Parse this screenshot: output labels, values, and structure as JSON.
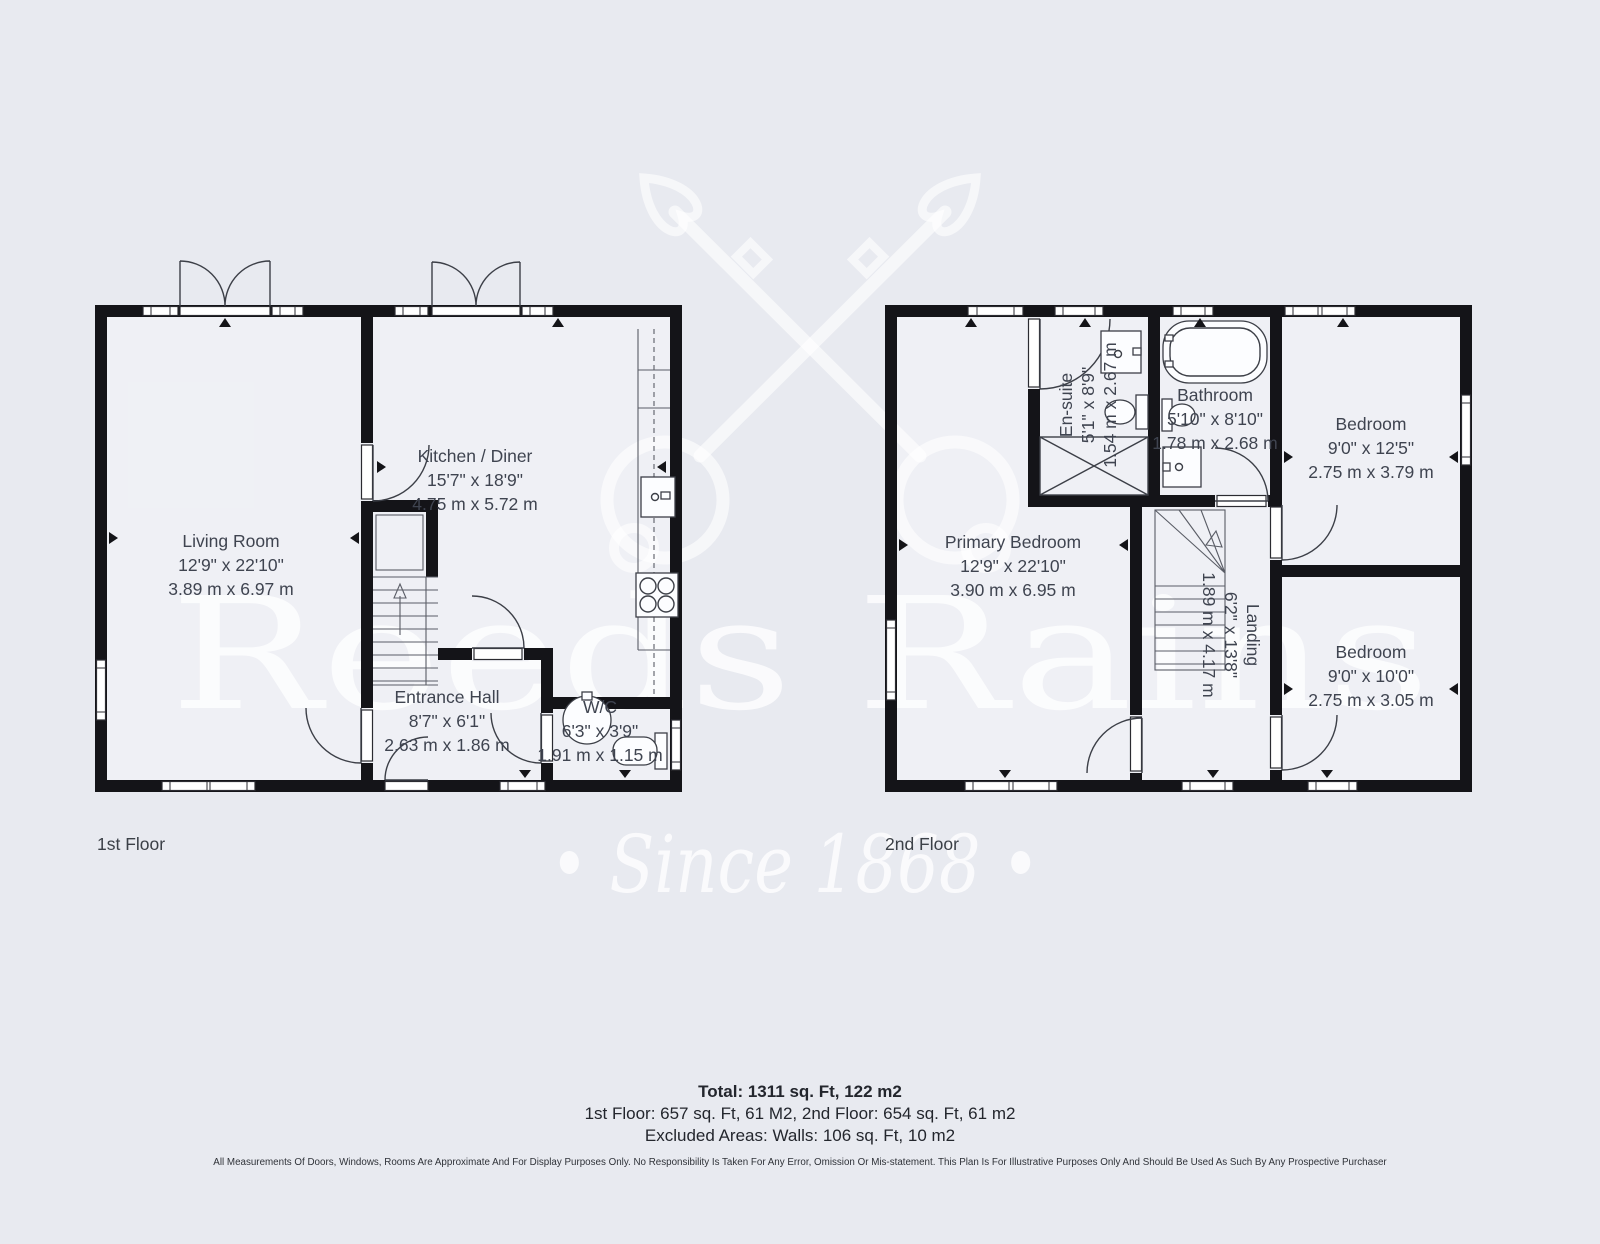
{
  "colors": {
    "background": "#e8eaf0",
    "wall": "#141418",
    "label_text": "#3f4450",
    "watermark": "#ffffff"
  },
  "watermark": {
    "brand": "Reeds Rains",
    "since": "• Since 1868 •",
    "emblem_icon": "crossed-keys"
  },
  "floor1": {
    "label": "1st Floor",
    "living": {
      "name": "Living Room",
      "imperial": "12'9\" x 22'10\"",
      "metric": "3.89 m x 6.97 m"
    },
    "kitchen": {
      "name": "Kitchen / Diner",
      "imperial": "15'7\" x 18'9\"",
      "metric": "4.75 m x 5.72 m"
    },
    "hall": {
      "name": "Entrance Hall",
      "imperial": "8'7\" x 6'1\"",
      "metric": "2.63 m x 1.86 m"
    },
    "wc": {
      "name": "W/C",
      "imperial": "6'3\" x 3'9\"",
      "metric": "1.91 m x 1.15 m"
    }
  },
  "floor2": {
    "label": "2nd Floor",
    "primary": {
      "name": "Primary Bedroom",
      "imperial": "12'9\" x 22'10\"",
      "metric": "3.90 m x 6.95 m"
    },
    "ensuite": {
      "name": "En-suite",
      "imperial": "5'1\" x 8'9\"",
      "metric": "1.54 m x 2.67 m"
    },
    "bathroom": {
      "name": "Bathroom",
      "imperial": "5'10\" x 8'10\"",
      "metric": "1.78 m x 2.68 m"
    },
    "bedroom1": {
      "name": "Bedroom",
      "imperial": "9'0\" x 12'5\"",
      "metric": "2.75 m x 3.79 m"
    },
    "landing": {
      "name": "Landing",
      "imperial": "6'2\" x 13'8\"",
      "metric": "1.89 m x 4.17 m"
    },
    "bedroom2": {
      "name": "Bedroom",
      "imperial": "9'0\" x 10'0\"",
      "metric": "2.75 m x 3.05 m"
    }
  },
  "summary": {
    "total": "Total: 1311 sq. Ft, 122 m2",
    "floors": "1st Floor: 657 sq. Ft, 61 M2, 2nd Floor: 654 sq. Ft, 61 m2",
    "excluded": "Excluded Areas: Walls: 106 sq. Ft, 10 m2"
  },
  "disclaimer": "All Measurements Of Doors, Windows, Rooms Are Approximate And For Display Purposes Only. No Responsibility Is Taken For Any Error, Omission Or Mis-statement. This Plan Is For Illustrative Purposes Only And Should Be Used As Such By Any Prospective Purchaser"
}
